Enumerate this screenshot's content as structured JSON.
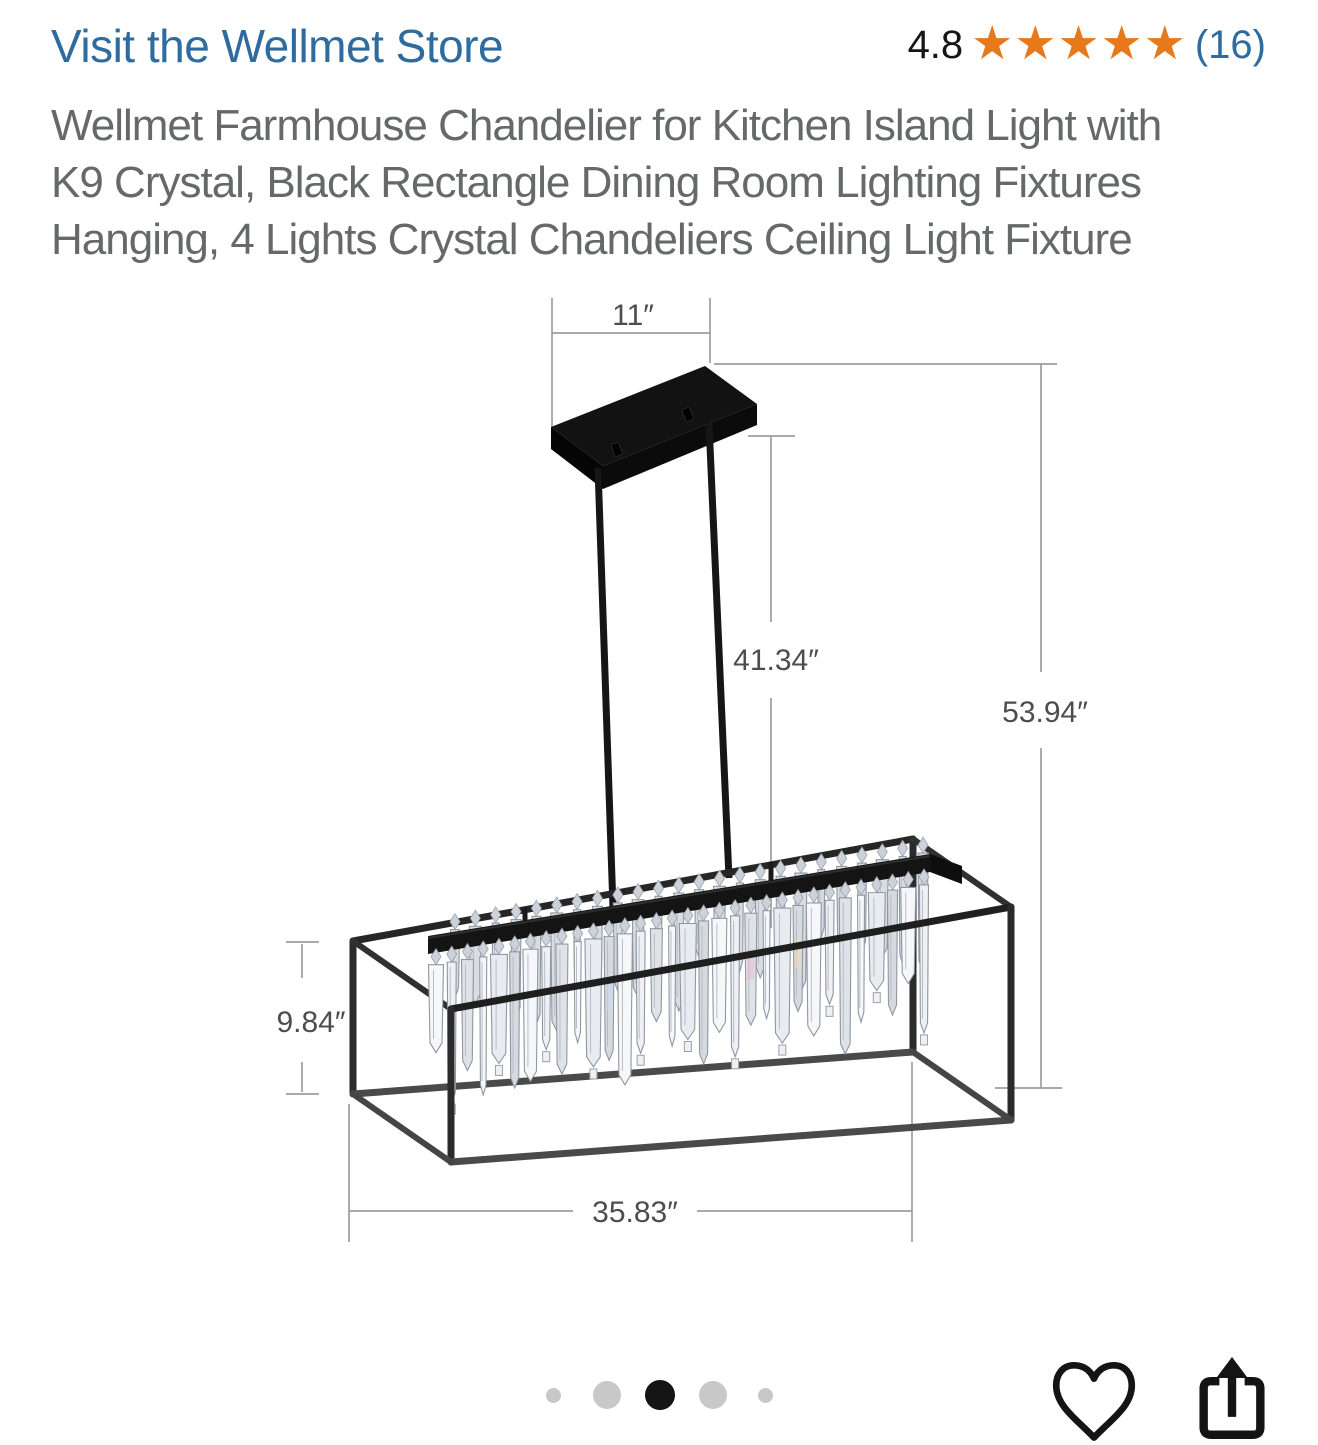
{
  "header": {
    "store_link": "Visit the Wellmet Store",
    "rating_value": "4.8",
    "star_count": 5,
    "rating_count": "(16)",
    "title_lines": [
      "Wellmet Farmhouse Chandelier for Kitchen Island Light with",
      "K9 Crystal, Black Rectangle Dining Room Lighting Fixtures",
      "Hanging, 4 Lights Crystal Chandeliers Ceiling Light Fixture"
    ]
  },
  "product_image": {
    "type": "dimension-diagram",
    "subject": "black rectangular crystal chandelier with ceiling canopy and two hanging rods",
    "dimensions": {
      "canopy_width": "11″",
      "rod_drop": "41.34″",
      "overall_height": "53.94″",
      "frame_height": "9.84″",
      "frame_length": "35.83″"
    }
  },
  "carousel": {
    "dot_count": 5,
    "active_index": 2
  },
  "actions": {
    "wishlist_icon": "heart-icon",
    "share_icon": "share-icon"
  },
  "colors": {
    "link_blue": "#2e6b9f",
    "star_orange": "#e5791c",
    "title_gray": "#65696a",
    "dim_line_gray": "#9e9e9e",
    "dim_text_gray": "#4d4d4d",
    "frame_black": "#242424",
    "active_dot": "#141414",
    "inactive_dot": "#c8c8c8"
  }
}
